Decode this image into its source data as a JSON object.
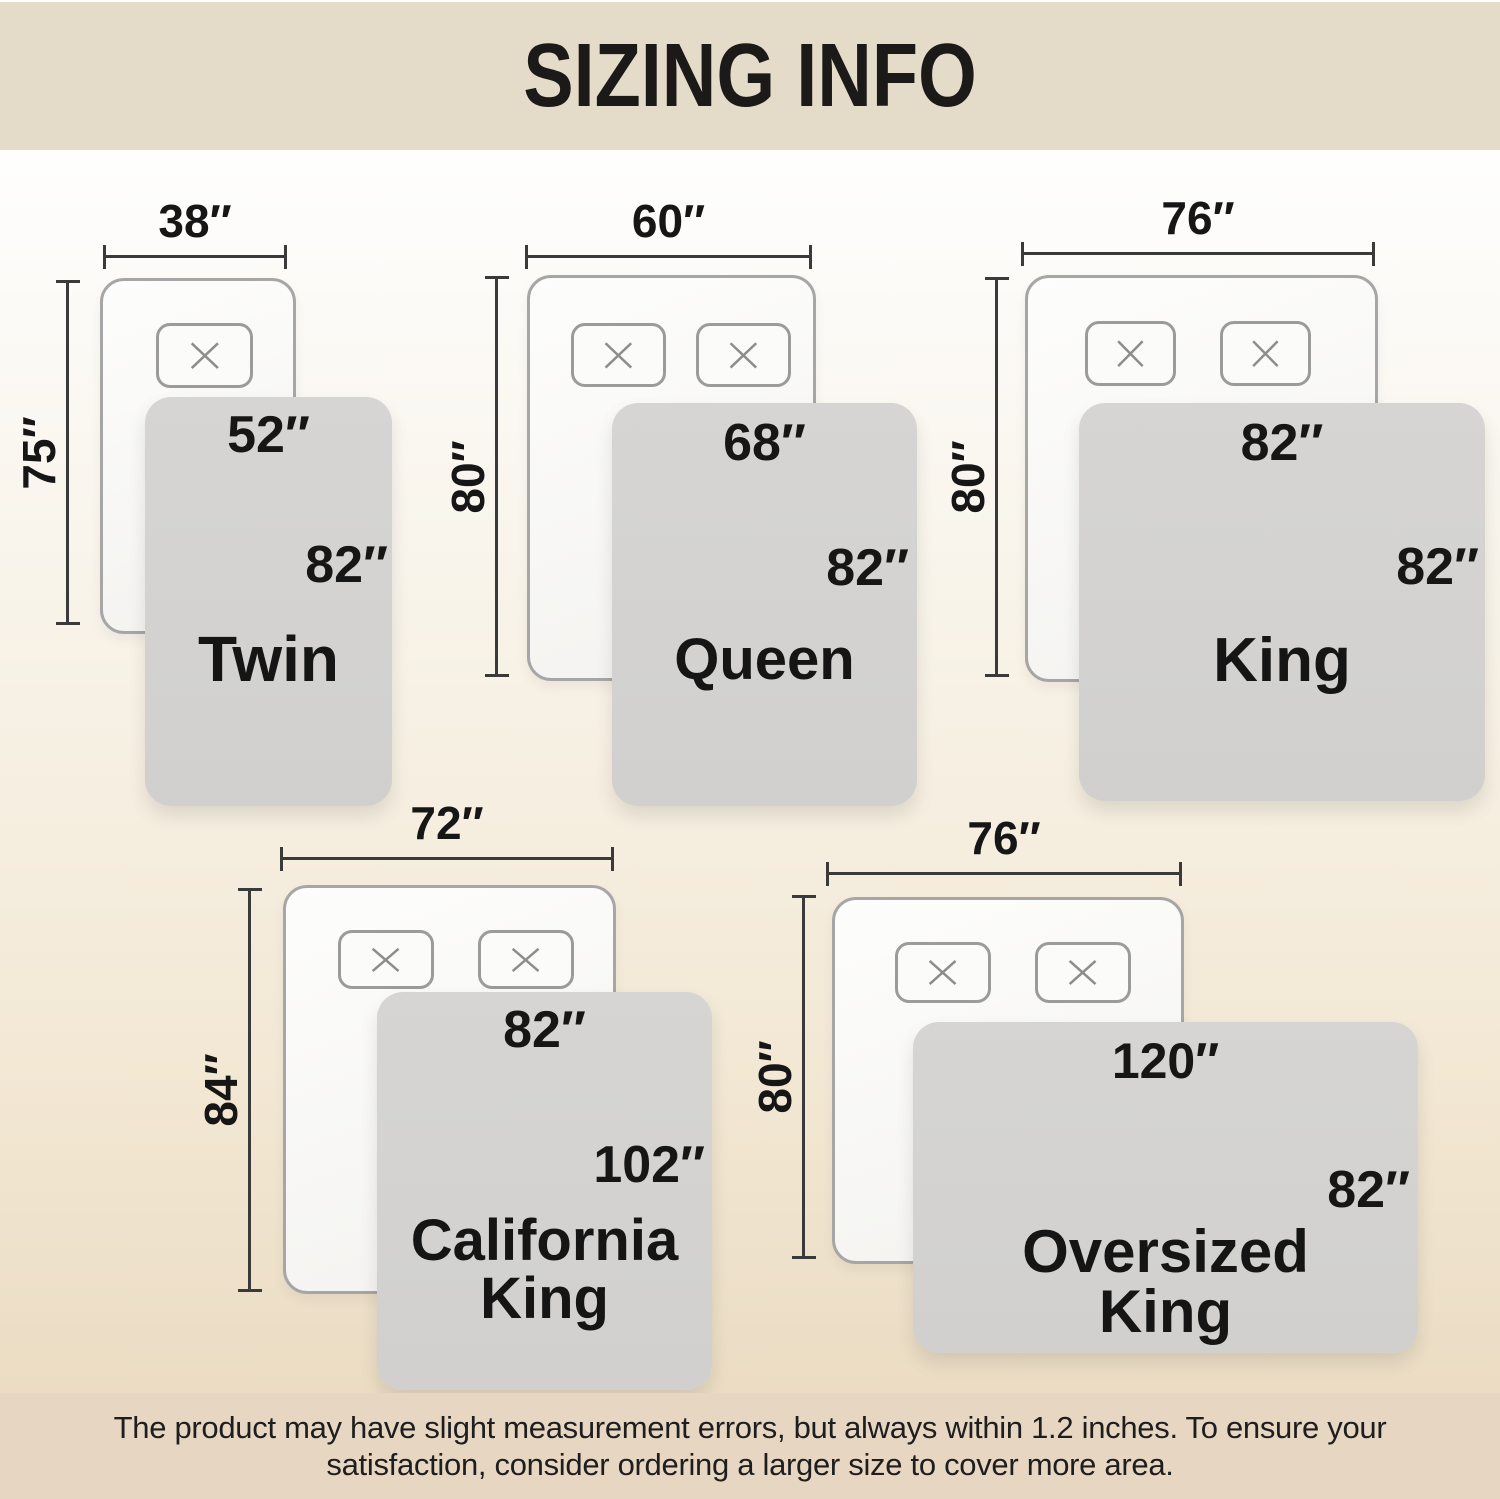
{
  "header": {
    "title": "SIZING INFO"
  },
  "footer": {
    "line1": "The product may have slight measurement errors, but always within 1.2 inches. To ensure your",
    "line2": "satisfaction, consider ordering a larger size to cover more area."
  },
  "colors": {
    "header_band": "#e4dbc8",
    "footer_band": "#e7d7c2",
    "background_top": "#fefefe",
    "background_bottom": "#eadbc2",
    "blanket_gray": "#d3d2d0",
    "bed_border": "#a6a6a6",
    "dimension_line": "#3a3a3a",
    "text": "#161616"
  },
  "diagrams": [
    {
      "id": "twin",
      "name": "Twin",
      "bed_width": "38″",
      "bed_length": "75″",
      "blanket_width": "52″",
      "blanket_length": "82″",
      "pillows": 1
    },
    {
      "id": "queen",
      "name": "Queen",
      "bed_width": "60″",
      "bed_length": "80″",
      "blanket_width": "68″",
      "blanket_length": "82″",
      "pillows": 2
    },
    {
      "id": "king",
      "name": "King",
      "bed_width": "76″",
      "bed_length": "80″",
      "blanket_width": "82″",
      "blanket_length": "82″",
      "pillows": 2
    },
    {
      "id": "california-king",
      "name": "California King",
      "bed_width": "72″",
      "bed_length": "84″",
      "blanket_width": "82″",
      "blanket_length": "102″",
      "pillows": 2
    },
    {
      "id": "oversized-king",
      "name": "Oversized King",
      "bed_width": "76″",
      "bed_length": "80″",
      "blanket_width": "120″",
      "blanket_length": "82″",
      "pillows": 2
    }
  ]
}
